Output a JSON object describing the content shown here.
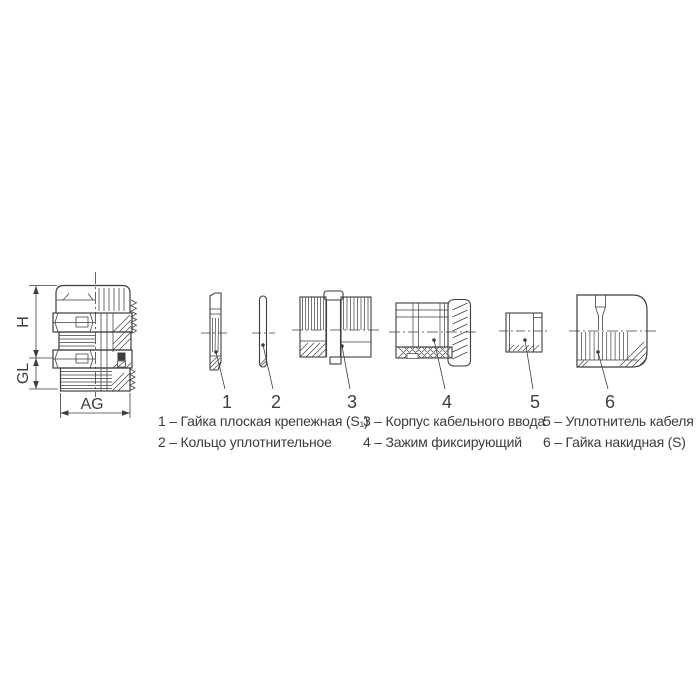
{
  "colors": {
    "line": "#3e3e3e",
    "text": "#3c3c3c",
    "background": "#ffffff"
  },
  "assembled_view": {
    "dim_height_label": "H",
    "dim_gland_length_label": "GL",
    "dim_thread_label": "AG"
  },
  "callouts": [
    "1",
    "2",
    "3",
    "4",
    "5",
    "6"
  ],
  "legend": {
    "columns": [
      {
        "items": [
          "1 – Гайка плоская крепежная (S₁)",
          "2 – Кольцо уплотнительное"
        ]
      },
      {
        "items": [
          "3 – Корпус кабельного ввода",
          "4 – Зажим фиксирующий"
        ]
      },
      {
        "items": [
          "5 – Уплотнитель кабеля",
          "6 – Гайка накидная (S)"
        ]
      }
    ]
  }
}
